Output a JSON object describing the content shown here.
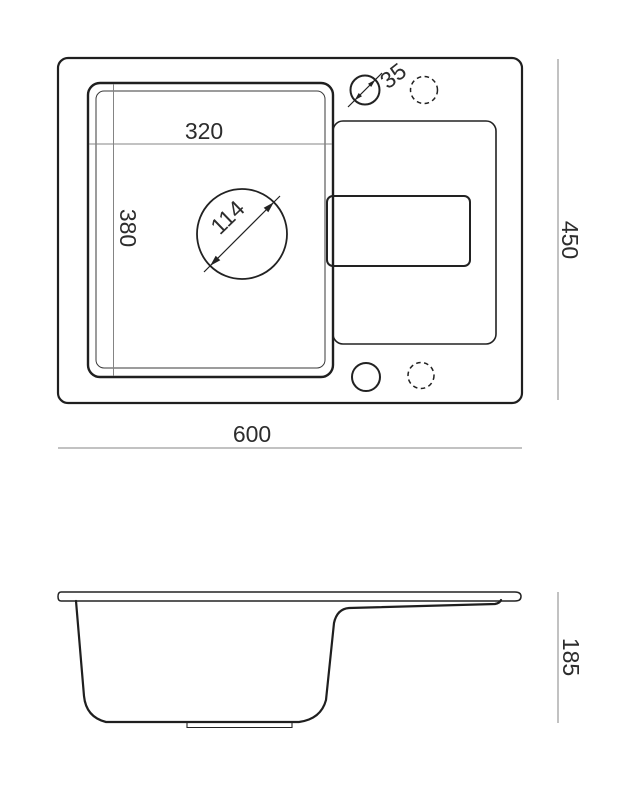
{
  "drawing_title": "sink-technical-drawing",
  "top_view": {
    "labels": {
      "basin_width": "320",
      "basin_length": "380",
      "drain_diameter": "114",
      "hole_diameter": "35",
      "overall_width": "600",
      "overall_height": "450"
    }
  },
  "side_view": {
    "labels": {
      "overall_depth": "185"
    }
  },
  "colors": {
    "outline": "#222222",
    "dimension_line": "#848484",
    "label_text": "#2d2d2d",
    "background": "#ffffff"
  }
}
